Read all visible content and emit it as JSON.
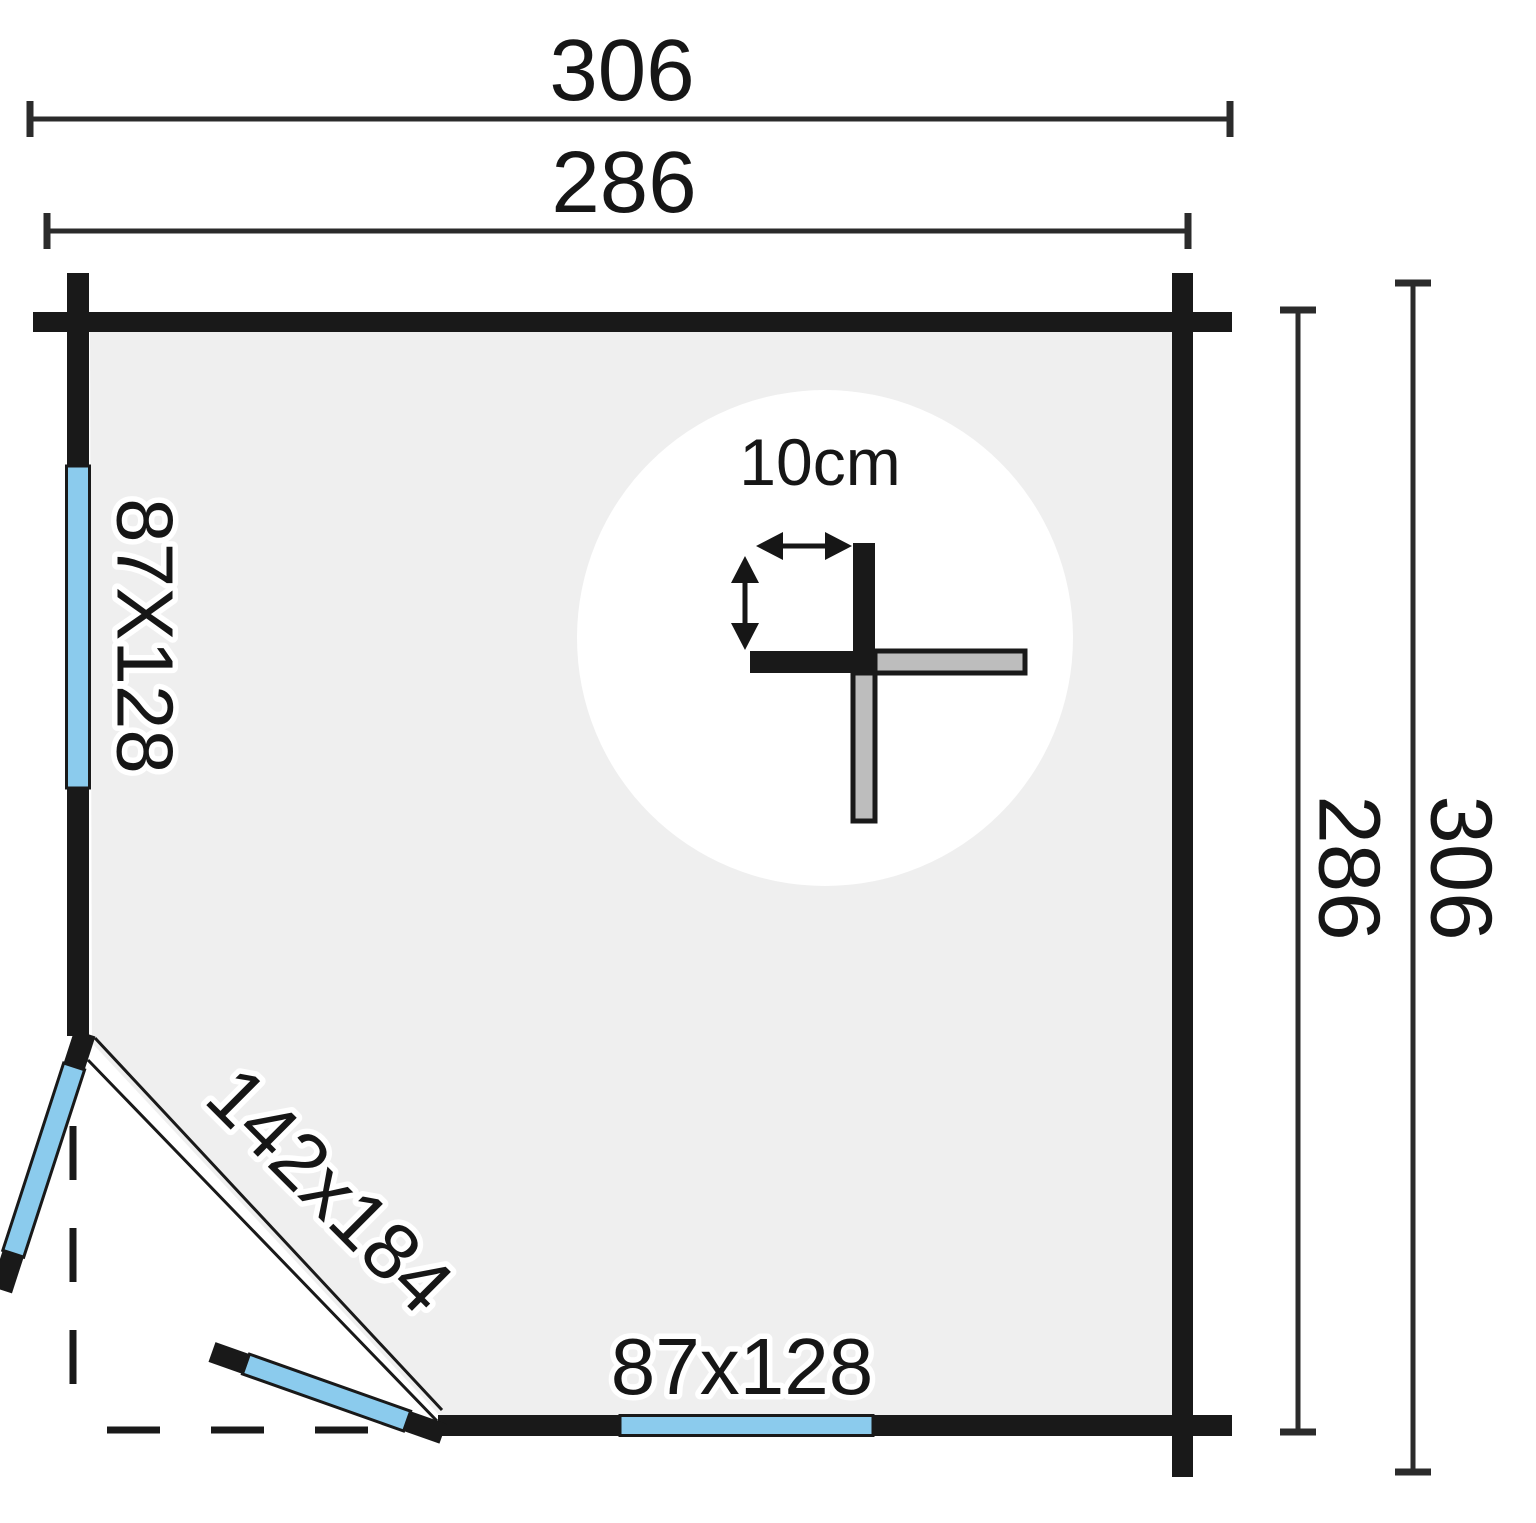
{
  "plan": {
    "dimensions": {
      "top_outer": "306",
      "top_inner": "286",
      "right_outer": "306",
      "right_inner": "286"
    },
    "openings": {
      "left_window_label": "87X128",
      "bottom_window_label": "87x128",
      "door_label": "142x184"
    },
    "wall_detail": {
      "thickness_label": "10cm"
    },
    "colors": {
      "background": "#ffffff",
      "floor": "#efefef",
      "wall": "#191919",
      "glazing": "#8bcbed",
      "log_grey": "#bdbdbd",
      "dimension_line": "#2b2b2b",
      "text": "#161616"
    }
  }
}
